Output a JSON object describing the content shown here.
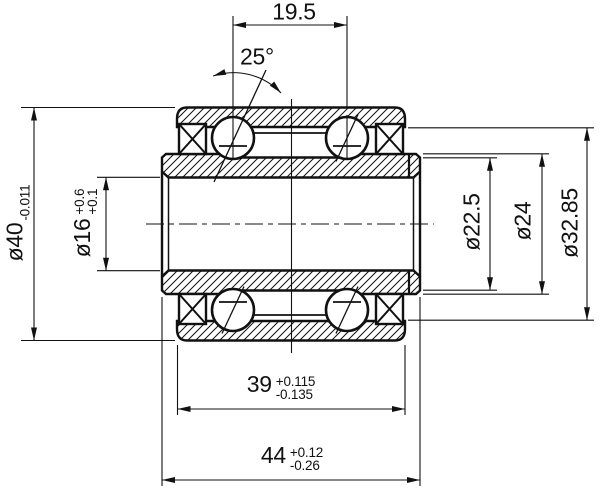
{
  "colors": {
    "ink": "#111111",
    "paper": "#ffffff"
  },
  "dimensions": {
    "ball_row_spacing": {
      "value": "19.5"
    },
    "contact_angle": {
      "value": "25°"
    },
    "outer_diameter": {
      "value": "ø40",
      "tol_lower": "-0.011"
    },
    "bore_diameter": {
      "value": "ø16",
      "tol_upper": "+0.6",
      "tol_lower": "+0.1"
    },
    "inner_ring_groove_diameter": {
      "value": "ø22.5"
    },
    "inner_ring_land_diameter": {
      "value": "ø24"
    },
    "outer_ring_bore_diameter": {
      "value": "ø32.85"
    },
    "outer_ring_width": {
      "value": "39",
      "tol_upper": "+0.115",
      "tol_lower": "-0.135"
    },
    "overall_width": {
      "value": "44",
      "tol_upper": "+0.12",
      "tol_lower": "-0.26"
    }
  }
}
